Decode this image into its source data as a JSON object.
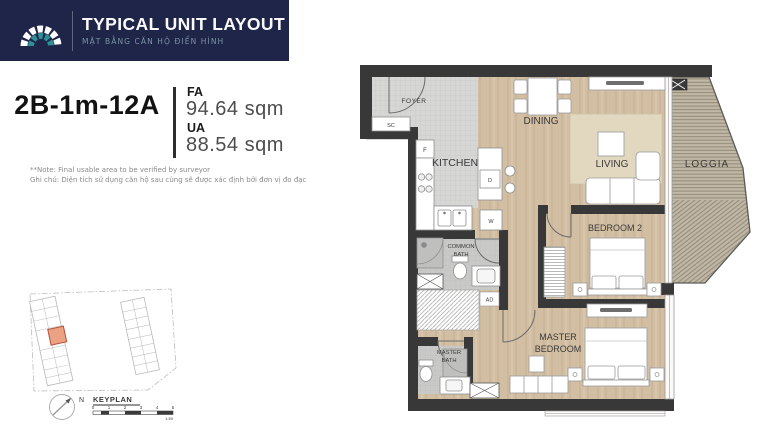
{
  "header": {
    "title": "TYPICAL UNIT LAYOUT",
    "subtitle": "MẶT BẰNG CĂN HỘ ĐIỂN HÌNH"
  },
  "unit_info": {
    "code": "2B-1m-12A",
    "fa_label": "FA",
    "fa_value": "94.64 sqm",
    "ua_label": "UA",
    "ua_value": "88.54 sqm"
  },
  "notes": {
    "line1": "**Note: Final usable area to be verified by surveyor",
    "line2": "Ghi chú: Diện tích sử dụng căn hộ sau cùng sẽ được xác định bởi đơn vị đo đạc"
  },
  "keyplan": {
    "title": "KEYPLAN",
    "north": "N",
    "scale_ticks": [
      "0",
      "1",
      "2",
      "3",
      "4",
      "5"
    ],
    "scale_ratio": "1:50"
  },
  "floorplan": {
    "rooms": {
      "foyer": "FOYER",
      "kitchen": "KITCHEN",
      "dining": "DINING",
      "living": "LIVING",
      "loggia": "LOGGIA",
      "bedroom2": "BEDROOM 2",
      "master_line1": "MASTER",
      "master_line2": "BEDROOM",
      "common_bath_line1": "COMMON",
      "common_bath_line2": "BATH",
      "master_bath_line1": "MASTER",
      "master_bath_line2": "BATH"
    },
    "fixtures": {
      "shoe_cabinet": "SC",
      "fridge": "F",
      "dishwasher": "D",
      "washer": "W",
      "duct": "AD"
    },
    "colors": {
      "wall": "#383838",
      "wood": "#d2bea2",
      "tile_gray": "#d6d6d4",
      "bath_gray": "#c9c9c7",
      "loggia": "#c0b7a4",
      "rug": "#e2d8c0",
      "navy": "#1e2548",
      "teal": "#2e8f96",
      "keyplan_highlight": "#eba183"
    }
  }
}
